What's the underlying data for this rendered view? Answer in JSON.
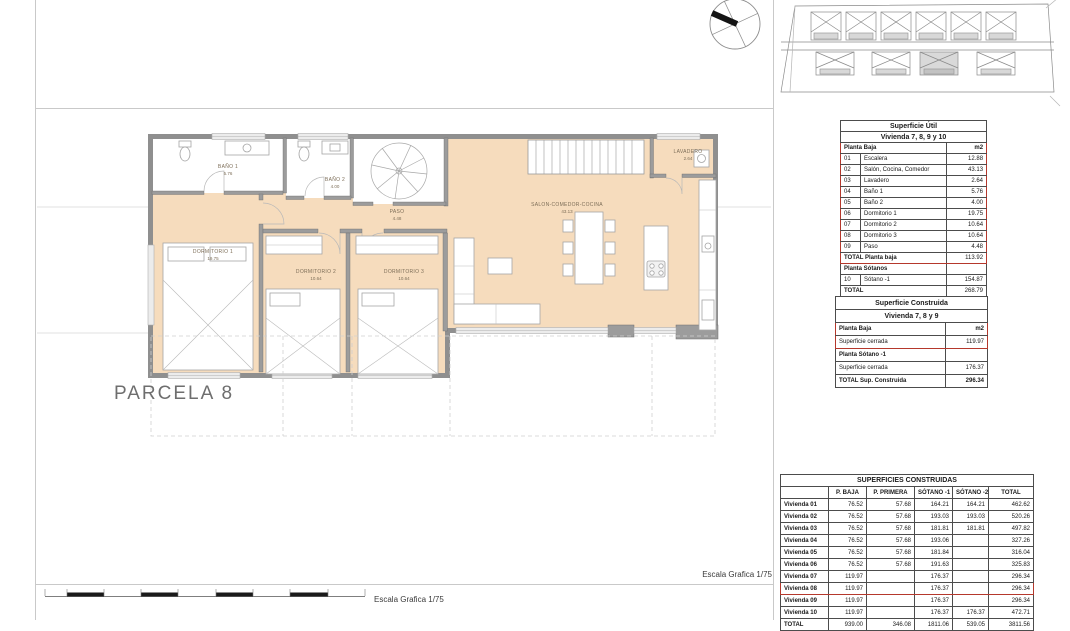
{
  "labels": {
    "parcela": "PARCELA 8",
    "escala_plan": "Escala Grafica 1/75",
    "escala_bar": "Escala Grafica 1/75"
  },
  "plan": {
    "rooms": [
      {
        "name": "BAÑO 1",
        "area": "5.76",
        "x": 228,
        "y": 164
      },
      {
        "name": "BAÑO 2",
        "area": "4.00",
        "x": 335,
        "y": 177
      },
      {
        "name": "DORMITORIO 1",
        "area": "19.75",
        "x": 213,
        "y": 249
      },
      {
        "name": "PASO",
        "area": "4.48",
        "x": 397,
        "y": 209
      },
      {
        "name": "DORMITORIO 2",
        "area": "10.64",
        "x": 316,
        "y": 269
      },
      {
        "name": "DORMITORIO 3",
        "area": "10.64",
        "x": 404,
        "y": 269
      },
      {
        "name": "SALON-COMEDOR-COCINA",
        "area": "43.13",
        "x": 567,
        "y": 202
      },
      {
        "name": "LAVADERO",
        "area": "2.64",
        "x": 688,
        "y": 149
      }
    ]
  },
  "superficie_util": {
    "title": "Superficie Útil",
    "subtitle": "Vivienda 7, 8, 9 y 10",
    "section1_label": "Planta Baja",
    "unit": "m2",
    "rows": [
      {
        "code": "01",
        "name": "Escalera",
        "value": "12.88"
      },
      {
        "code": "02",
        "name": "Salón, Cocina, Comedor",
        "value": "43.13"
      },
      {
        "code": "03",
        "name": "Lavadero",
        "value": "2.64"
      },
      {
        "code": "04",
        "name": "Baño 1",
        "value": "5.76"
      },
      {
        "code": "05",
        "name": "Baño 2",
        "value": "4.00"
      },
      {
        "code": "06",
        "name": "Dormitorio 1",
        "value": "19.75"
      },
      {
        "code": "07",
        "name": "Dormitorio 2",
        "value": "10.64"
      },
      {
        "code": "08",
        "name": "Dormitorio 3",
        "value": "10.64"
      },
      {
        "code": "09",
        "name": "Paso",
        "value": "4.48"
      }
    ],
    "total_row": {
      "label": "TOTAL Planta baja",
      "value": "113.92"
    },
    "section2_label": "Planta Sótanos",
    "sotano_row": {
      "code": "10",
      "name": "Sótano -1",
      "value": "154.87"
    },
    "grand_total": {
      "label": "TOTAL",
      "value": "268.79"
    }
  },
  "superficie_construida": {
    "title": "Superficie Construida",
    "subtitle": "Vivienda 7, 8 y 9",
    "rows": [
      {
        "label": "Planta Baja",
        "value": "m2",
        "bold": true,
        "red": true
      },
      {
        "label": "Superficie cerrada",
        "value": "119.97",
        "red": true
      },
      {
        "label": "Planta Sótano -1",
        "value": "",
        "bold": true
      },
      {
        "label": "Superficie cerrada",
        "value": "176.37"
      },
      {
        "label": "TOTAL Sup. Construida",
        "value": "296.34",
        "bold": true
      }
    ]
  },
  "superficies_construidas": {
    "title": "SUPERFICIES CONSTRUIDAS",
    "columns": [
      "",
      "P. BAJA",
      "P. PRIMERA",
      "SÓTANO -1",
      "SÓTANO -2",
      "TOTAL"
    ],
    "rows": [
      {
        "label": "Vivienda 01",
        "values": [
          "76.52",
          "57.68",
          "164.21",
          "164.21",
          "462.62"
        ]
      },
      {
        "label": "Vivienda 02",
        "values": [
          "76.52",
          "57.68",
          "193.03",
          "193.03",
          "520.26"
        ]
      },
      {
        "label": "Vivienda 03",
        "values": [
          "76.52",
          "57.68",
          "181.81",
          "181.81",
          "497.82"
        ]
      },
      {
        "label": "Vivienda 04",
        "values": [
          "76.52",
          "57.68",
          "193.06",
          "",
          "327.26"
        ]
      },
      {
        "label": "Vivienda 05",
        "values": [
          "76.52",
          "57.68",
          "181.84",
          "",
          "316.04"
        ]
      },
      {
        "label": "Vivienda 06",
        "values": [
          "76.52",
          "57.68",
          "191.63",
          "",
          "325.83"
        ]
      },
      {
        "label": "Vivienda 07",
        "values": [
          "119.97",
          "",
          "176.37",
          "",
          "296.34"
        ]
      },
      {
        "label": "Vivienda 08",
        "values": [
          "119.97",
          "",
          "176.37",
          "",
          "296.34"
        ],
        "highlight": true
      },
      {
        "label": "Vivienda 09",
        "values": [
          "119.97",
          "",
          "176.37",
          "",
          "296.34"
        ]
      },
      {
        "label": "Vivienda 10",
        "values": [
          "119.97",
          "",
          "176.37",
          "176.37",
          "472.71"
        ]
      },
      {
        "label": "TOTAL",
        "values": [
          "939.00",
          "346.08",
          "1811.06",
          "539.05",
          "3811.56"
        ],
        "bold": true
      }
    ]
  },
  "colors": {
    "floor": "#f6dcbd",
    "wall": "#8f8f8f",
    "highlight_red": "#b5382c"
  }
}
